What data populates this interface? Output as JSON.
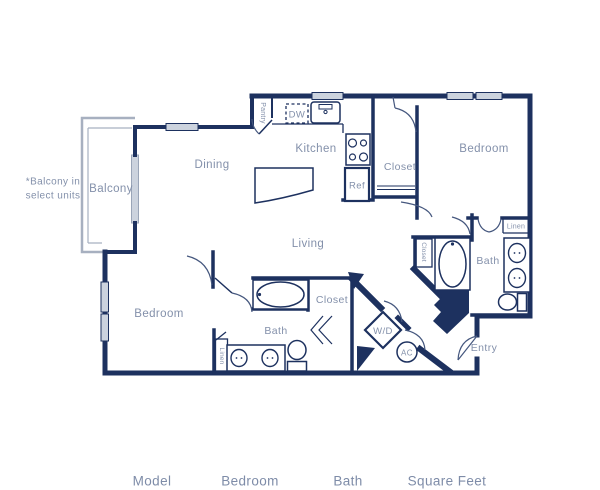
{
  "title": "Apartment floor plan",
  "colors": {
    "wall": "#1d315f",
    "label_text": "#8390aa",
    "window": "#ccd3de",
    "balcony_gray": "#a7b0c0"
  },
  "note": {
    "line1": "*Balcony in",
    "line2": "select units"
  },
  "labels": {
    "balcony": "Balcony",
    "dining": "Dining",
    "kitchen": "Kitchen",
    "pantry": "Pantry",
    "dw": "DW",
    "ref": "Ref",
    "closet_top": "Closet",
    "bedroom_top": "Bedroom",
    "linen_right": "Linen",
    "bath_right": "Bath",
    "closet_hall": "Closet",
    "living": "Living",
    "closet_mid": "Closet",
    "wd": "W/D",
    "ac": "AC",
    "entry": "Entry",
    "bedroom_left": "Bedroom",
    "bath_mid": "Bath",
    "linen_mid": "Linen"
  },
  "table": {
    "headers": [
      "Model",
      "Bedroom",
      "Bath",
      "Square Feet"
    ]
  }
}
